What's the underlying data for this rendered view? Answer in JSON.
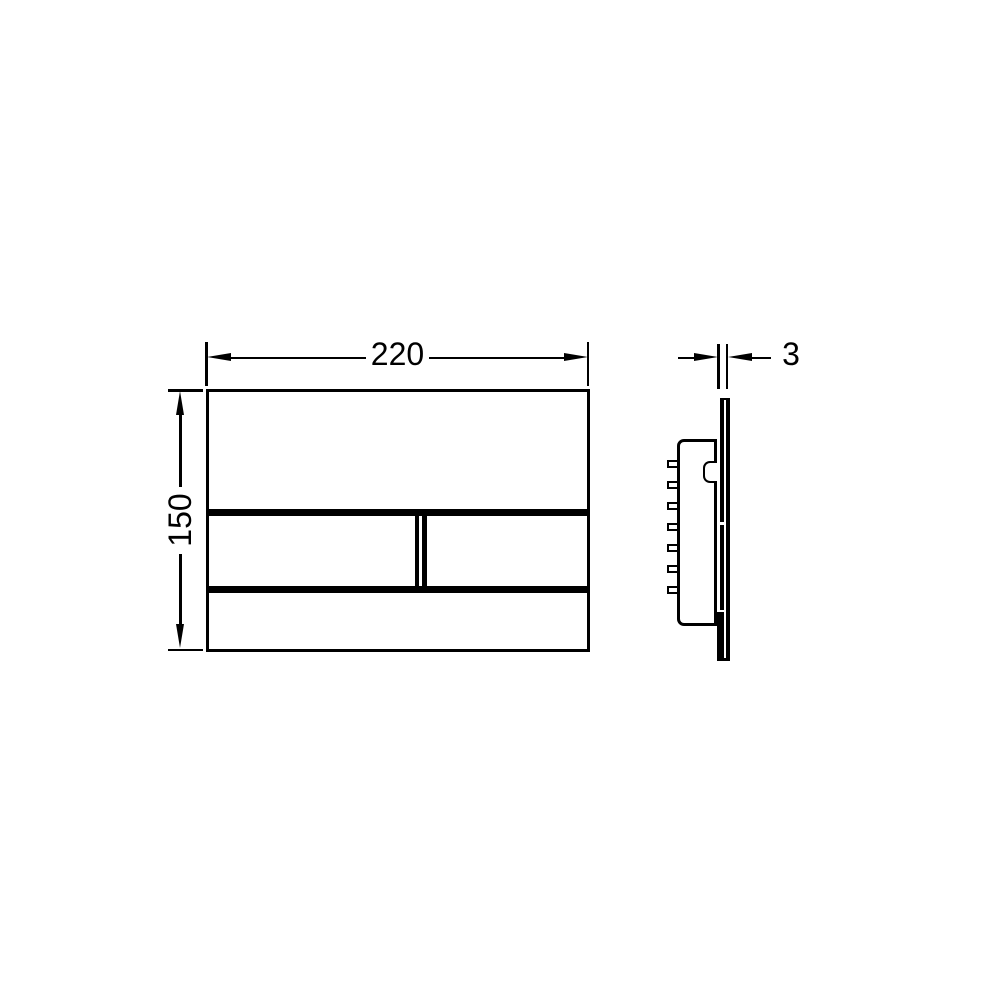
{
  "colors": {
    "background": "#ffffff",
    "line": "#000000"
  },
  "dimensions": {
    "width_label": "220",
    "height_label": "150",
    "thickness_label": "3"
  }
}
